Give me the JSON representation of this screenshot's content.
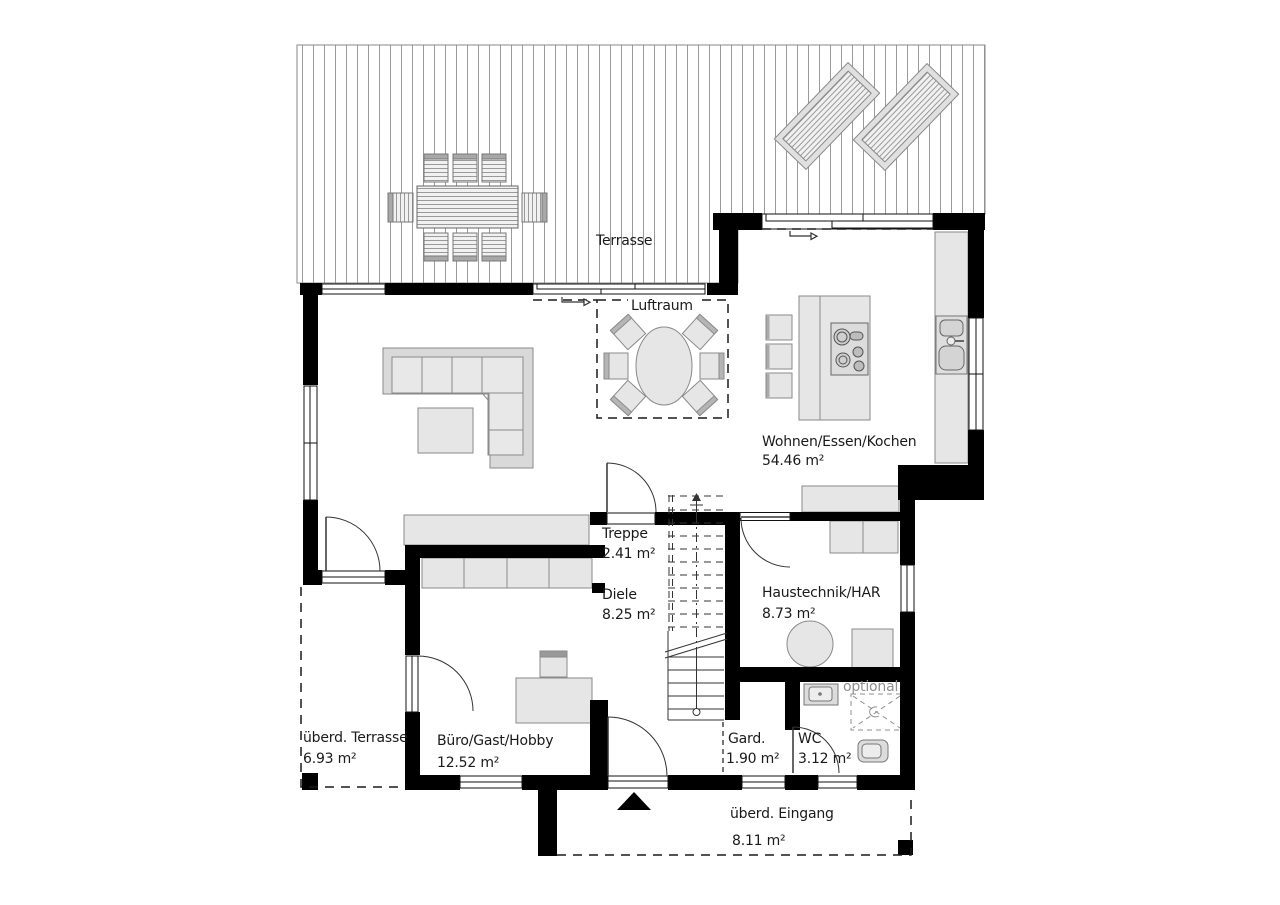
{
  "plan_type": "floor-plan",
  "colors": {
    "wall": "#000000",
    "furniture_fill": "#e6e6e6",
    "furniture_stroke": "#8a8a8a",
    "deck_line": "#9a9a9a",
    "text": "#1a1a1a",
    "muted_text": "#8f8f8f"
  },
  "rooms": {
    "terrasse": {
      "name": "Terrasse"
    },
    "luftraum": {
      "name": "Luftraum"
    },
    "wohnen": {
      "name": "Wohnen/Essen/Kochen",
      "area": "54.46 m²"
    },
    "treppe": {
      "name": "Treppe",
      "area": "2.41 m²"
    },
    "diele": {
      "name": "Diele",
      "area": "8.25 m²"
    },
    "haustechnik": {
      "name": "Haustechnik/HAR",
      "area": "8.73 m²"
    },
    "ueberdachte_terrasse": {
      "name": "überd. Terrasse",
      "area": "6.93 m²"
    },
    "buero": {
      "name": "Büro/Gast/Hobby",
      "area": "12.52 m²"
    },
    "garderobe": {
      "name": "Gard.",
      "area": "1.90 m²"
    },
    "wc": {
      "name": "WC",
      "area": "3.12 m²"
    },
    "ueberdachter_eingang": {
      "name": "überd. Eingang",
      "area": "8.11 m²"
    }
  },
  "annotations": {
    "optional": "optional"
  }
}
